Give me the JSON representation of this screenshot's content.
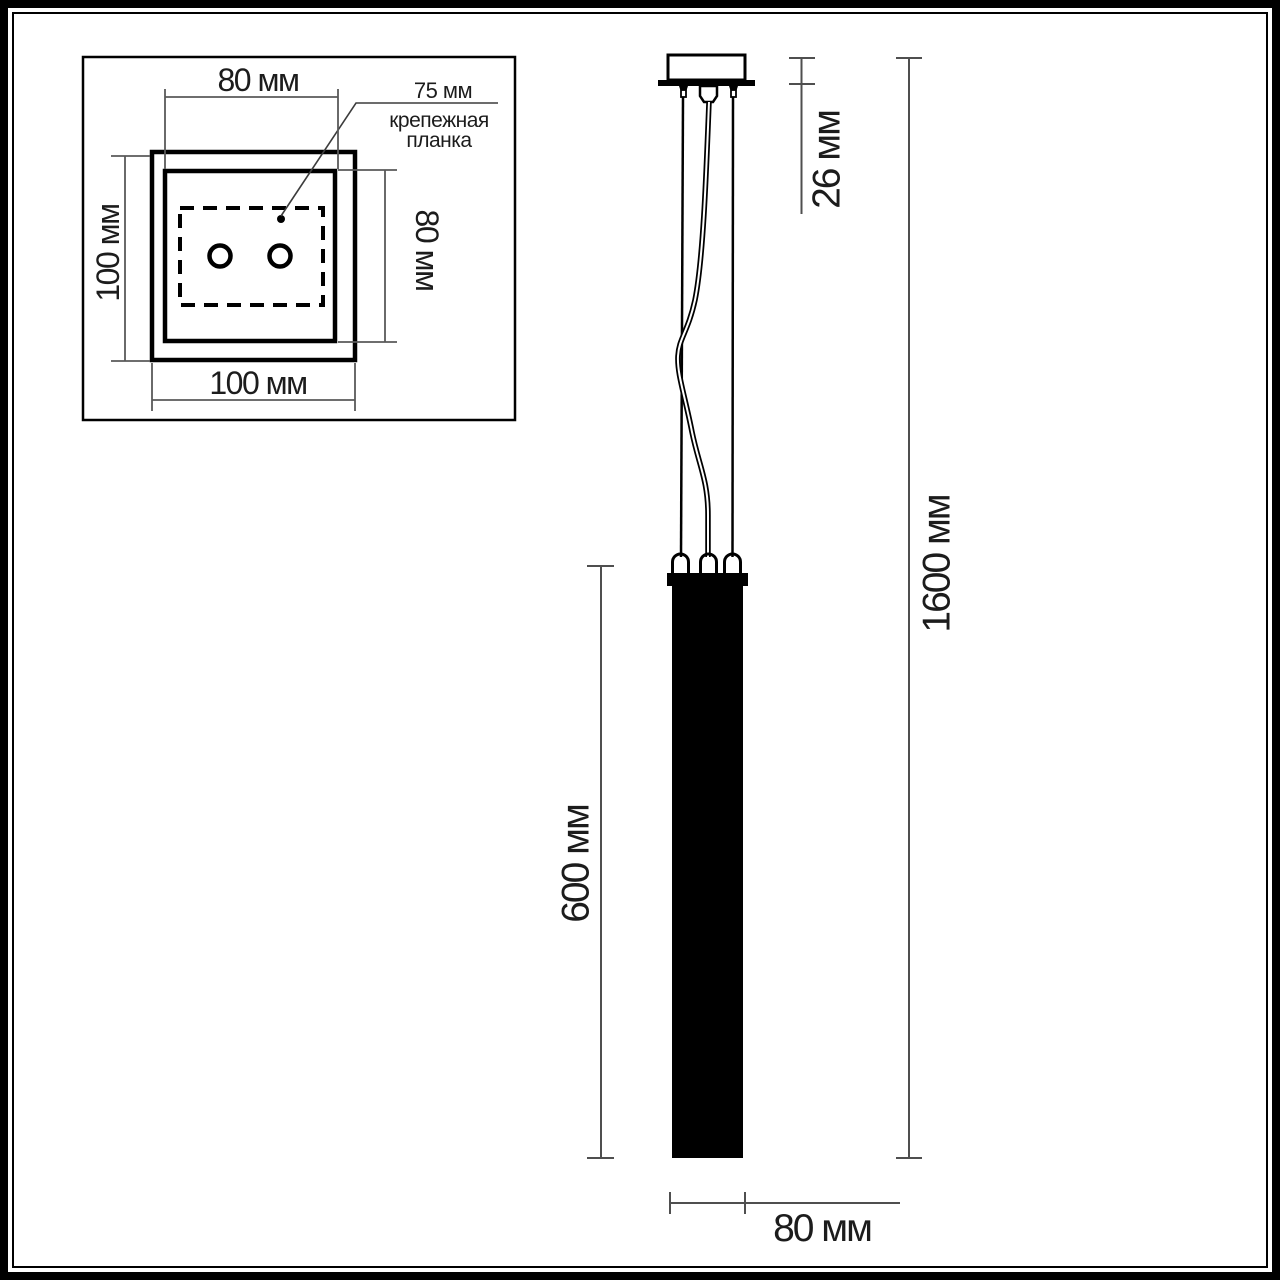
{
  "diagram": {
    "description": "pendant-light-dimension-drawing",
    "inset_top_view": {
      "dim_top": "80 мм",
      "dim_left": "100 мм",
      "dim_right": "80 мм",
      "dim_bottom": "100 мм",
      "callout": {
        "value": "75 мм",
        "label_line1": "крепежная",
        "label_line2": "планка"
      }
    },
    "front_view": {
      "dim_canopy_height": "26 мм",
      "dim_total_height": "1600 мм",
      "dim_tube_length": "600 мм",
      "dim_tube_width": "80 мм"
    },
    "colors": {
      "drawing_line": "#000000",
      "dimension_line": "#595959",
      "text": "#1c1c1c",
      "background": "#ffffff"
    }
  }
}
